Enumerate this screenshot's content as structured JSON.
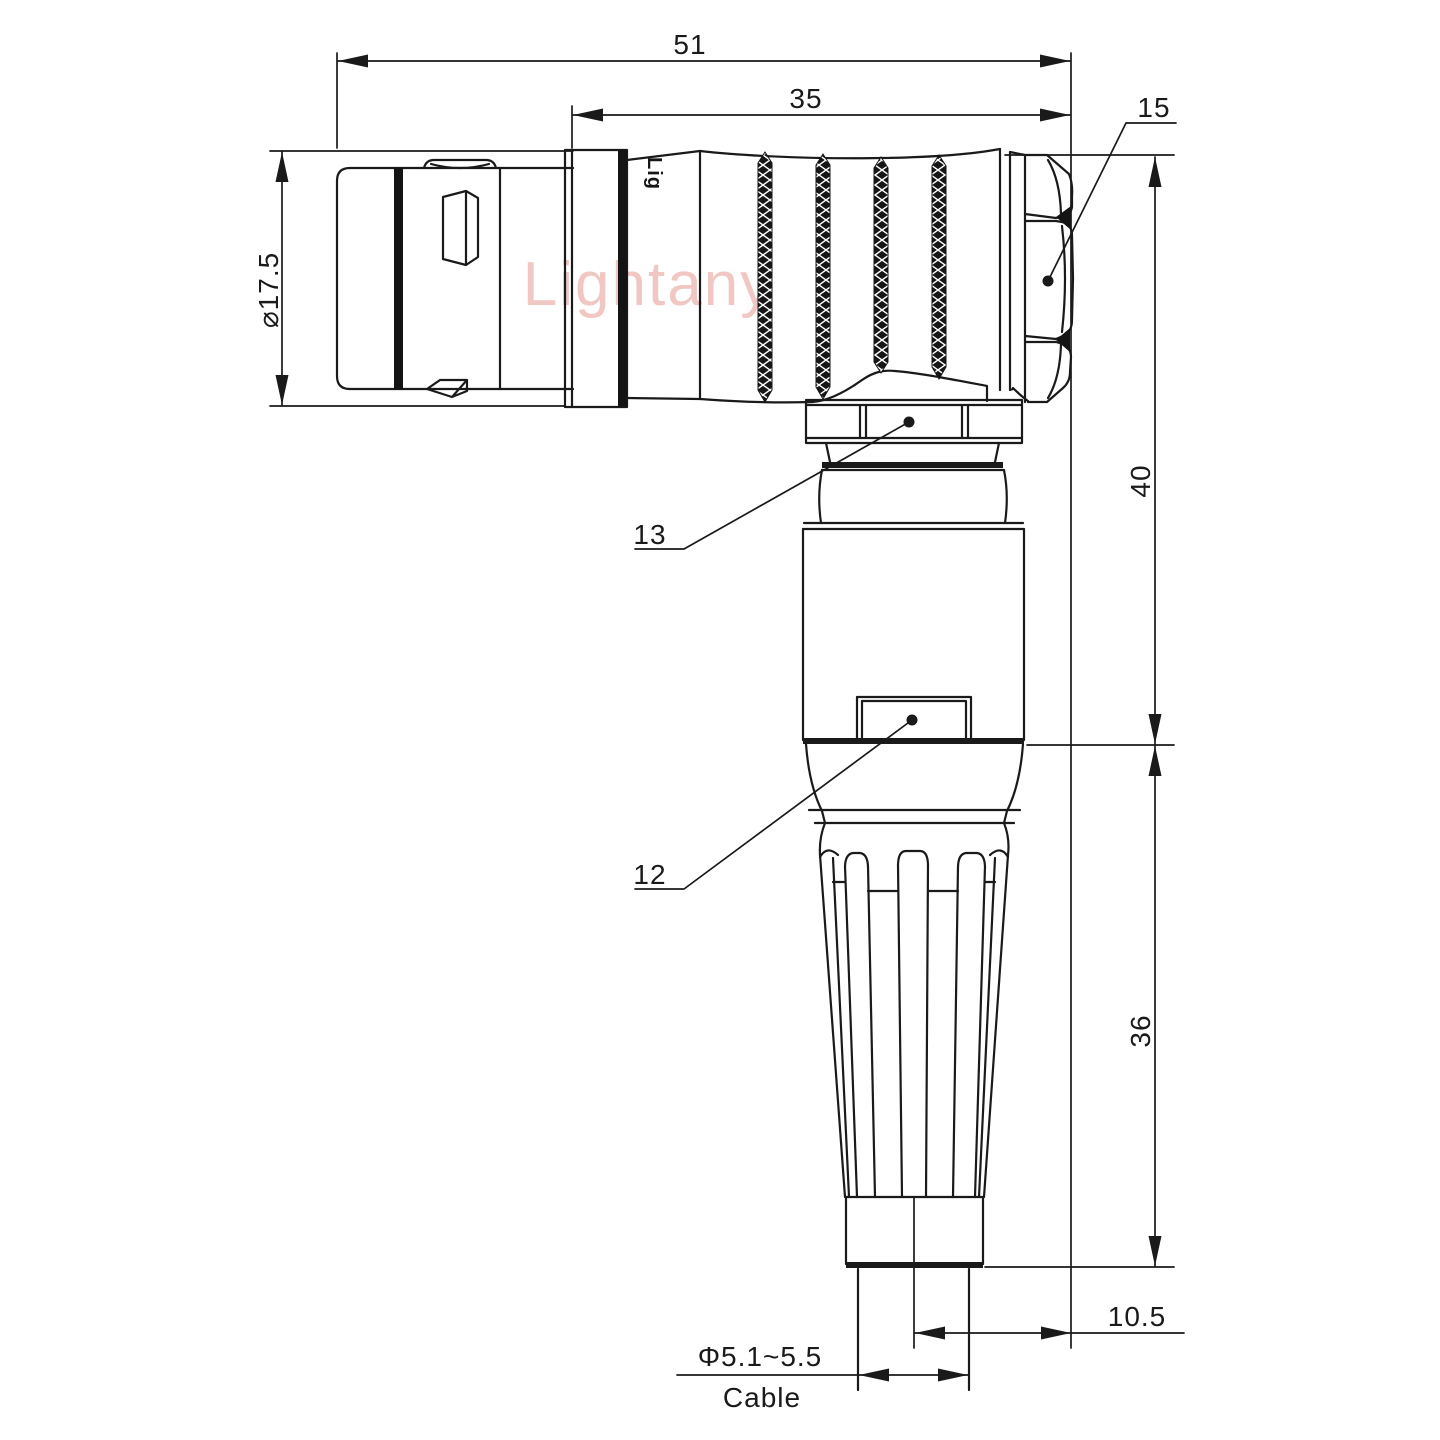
{
  "watermark": {
    "text": "Lightany",
    "color": "#f0c7c2"
  },
  "engraving": {
    "text": "Lig"
  },
  "dims": {
    "overall_length": "51",
    "grip_length": "35",
    "backnut_ref": "15",
    "plug_diameter": "⌀17.5",
    "height_upper": "40",
    "height_lower": "36",
    "coupling_ref": "13",
    "housing_ref": "12",
    "exit_offset": "10.5",
    "cable_diameter": "Φ5.1~5.5",
    "cable_label": "Cable"
  },
  "style": {
    "line_color": "#1a1a1a",
    "background": "#ffffff"
  }
}
